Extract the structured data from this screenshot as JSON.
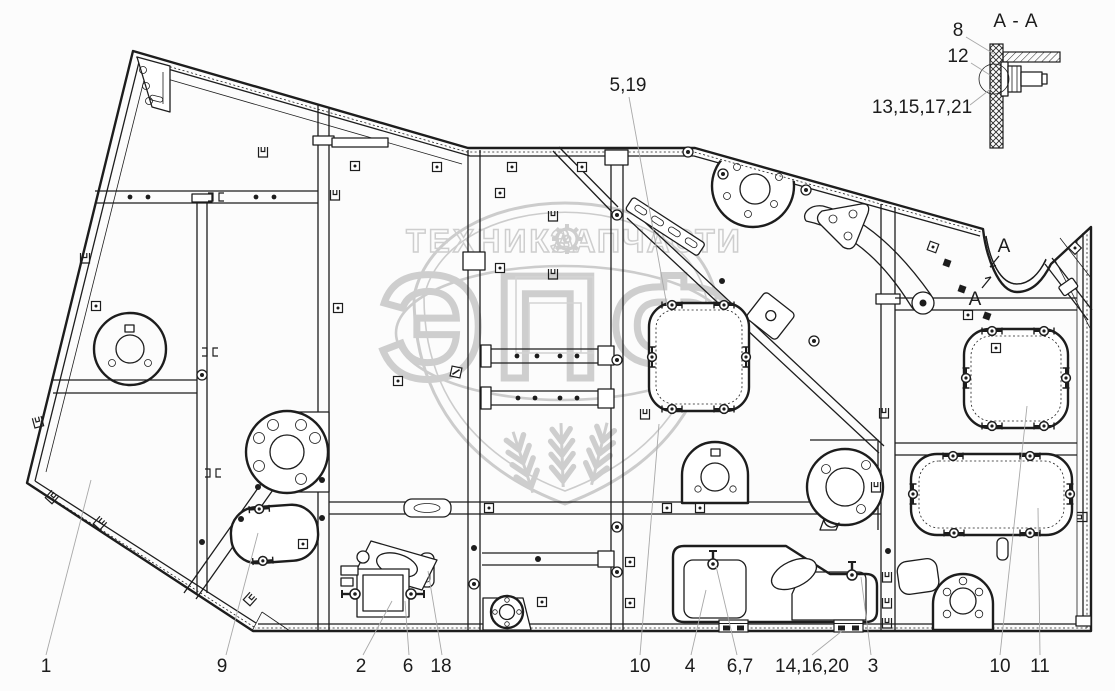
{
  "drawing_title": "side panel assembly drawing",
  "colors": {
    "background": "#fcfcfc",
    "line": "#1d1d1d",
    "leader_line": "#a8a8a8",
    "watermark": "#a9a9a9"
  },
  "callouts": {
    "items": [
      {
        "label": "1"
      },
      {
        "label": "9"
      },
      {
        "label": "2"
      },
      {
        "label": "6"
      },
      {
        "label": "18"
      },
      {
        "label": "10"
      },
      {
        "label": "4"
      },
      {
        "label": "6,7"
      },
      {
        "label": "14,16,20"
      },
      {
        "label": "3"
      },
      {
        "label": "10"
      },
      {
        "label": "11"
      },
      {
        "label": "5,19"
      }
    ]
  },
  "detail_view": {
    "title": "A - A",
    "labels": [
      {
        "text": "8"
      },
      {
        "text": "12"
      },
      {
        "text": "13,15,17,21"
      }
    ]
  },
  "section_markers": {
    "letter": "A"
  },
  "watermark": {
    "top_text_left": "ТЕХНИКА",
    "top_text_right": "ЗАПЧАСТИ",
    "big_text": "ЭПФ",
    "icons": [
      "shield-icon",
      "gear-icon",
      "wheat-icon"
    ]
  }
}
